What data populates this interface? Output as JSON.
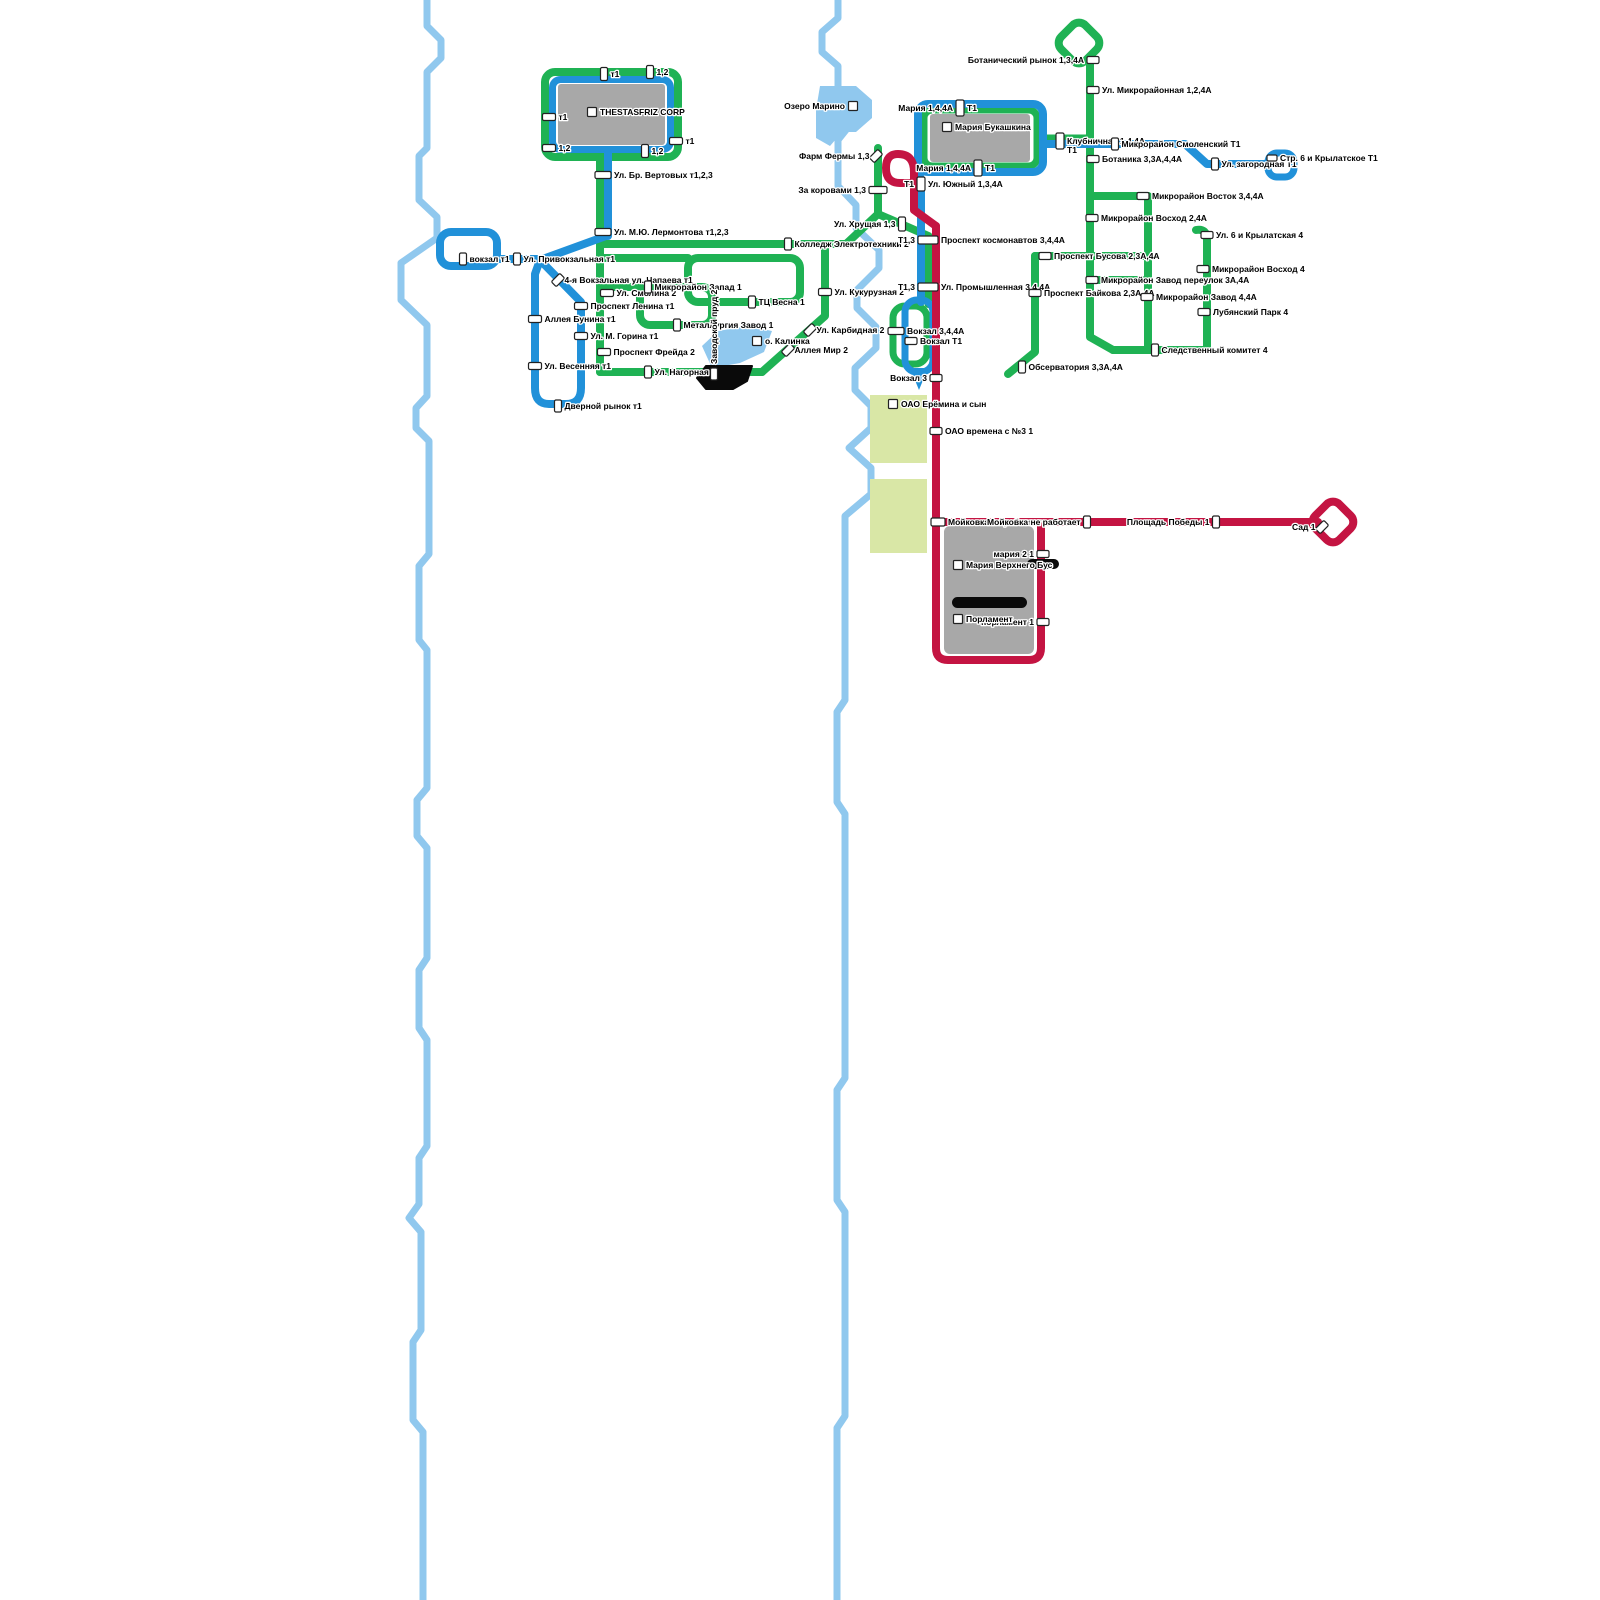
{
  "map": {
    "colors": {
      "route_green": "#1fb254",
      "route_blue": "#2191d9",
      "route_red": "#c41442",
      "river": "#90c8ee",
      "zone_green": "#d9e7a6",
      "building_gray": "#a8a8a8",
      "black": "#0a0a0a",
      "marker_fill": "#ffffff",
      "marker_stroke": "#222222"
    },
    "routes": [
      {
        "id": "green",
        "label": "1 / 2 / 3A / 4 / 4A",
        "color": "#1fb254"
      },
      {
        "id": "blue",
        "label": "T1",
        "color": "#2191d9"
      },
      {
        "id": "red",
        "label": "1 / 3",
        "color": "#c41442"
      }
    ],
    "stops": [
      {
        "x": 604,
        "y": 74,
        "w": 7,
        "h": 13,
        "right": "т1"
      },
      {
        "x": 650,
        "y": 72,
        "w": 7,
        "h": 13,
        "right": "1,2"
      },
      {
        "x": 549,
        "y": 117,
        "w": 13,
        "h": 7,
        "right": "т1"
      },
      {
        "x": 549,
        "y": 148,
        "w": 13,
        "h": 7,
        "right": "1,2"
      },
      {
        "x": 676,
        "y": 141,
        "w": 13,
        "h": 7,
        "right": "т1"
      },
      {
        "x": 645,
        "y": 151,
        "w": 7,
        "h": 13,
        "right": "1,2"
      },
      {
        "x": 603,
        "y": 175,
        "w": 16,
        "h": 7,
        "right": "Ул. Бр. Вертовых т1,2,3"
      },
      {
        "x": 603,
        "y": 232,
        "w": 16,
        "h": 7,
        "right": "Ул. М.Ю. Лермонтова т1,2,3"
      },
      {
        "x": 463,
        "y": 259,
        "w": 7,
        "h": 12,
        "right": "вокзал т1"
      },
      {
        "x": 517,
        "y": 259,
        "w": 7,
        "h": 12,
        "right": "Ул. Привокзальная т1"
      },
      {
        "x": 558,
        "y": 280,
        "w": 7,
        "h": 12,
        "rot": 45,
        "right": "4-я Вокзальная ул. Чапаева т1"
      },
      {
        "x": 607,
        "y": 293,
        "w": 13,
        "h": 7,
        "right": "Ул. Смолина 2"
      },
      {
        "x": 581,
        "y": 306,
        "w": 13,
        "h": 7,
        "right": "Проспект Ленина т1"
      },
      {
        "x": 535,
        "y": 319,
        "w": 13,
        "h": 7,
        "right": "Аллея Бунина т1"
      },
      {
        "x": 581,
        "y": 336,
        "w": 13,
        "h": 7,
        "right": "Ул. М. Горина т1"
      },
      {
        "x": 535,
        "y": 366,
        "w": 13,
        "h": 7,
        "right": "Ул. Весенняя т1"
      },
      {
        "x": 604,
        "y": 352,
        "w": 13,
        "h": 7,
        "right": "Проспект Фрейда 2"
      },
      {
        "x": 558,
        "y": 406,
        "w": 7,
        "h": 12,
        "right": "Дверной рынок т1"
      },
      {
        "x": 648,
        "y": 287,
        "w": 7,
        "h": 12,
        "right": "Микрорайон Запад 1"
      },
      {
        "x": 677,
        "y": 325,
        "w": 7,
        "h": 12,
        "right": "Металлургия Завод 1"
      },
      {
        "x": 752,
        "y": 302,
        "w": 7,
        "h": 12,
        "right": "ТЦ Весна 1"
      },
      {
        "x": 788,
        "y": 244,
        "w": 7,
        "h": 12,
        "right": "Колледж Электротехники 2"
      },
      {
        "x": 648,
        "y": 372,
        "w": 7,
        "h": 12,
        "right": "Ул. Нагорная 2"
      },
      {
        "x": 714,
        "y": 374,
        "w": 7,
        "h": 12,
        "vert": "Заводской пруд 2"
      },
      {
        "x": 825,
        "y": 292,
        "w": 13,
        "h": 7,
        "right": "Ул. Кукурузная 2"
      },
      {
        "x": 810,
        "y": 330,
        "w": 7,
        "h": 12,
        "rot": 45,
        "right": "Ул. Карбидная 2"
      },
      {
        "x": 788,
        "y": 350,
        "w": 7,
        "h": 12,
        "rot": 45,
        "right": "Аллея Мир 2"
      },
      {
        "x": 876,
        "y": 156,
        "w": 7,
        "h": 12,
        "rot": 45,
        "left": "Фарм Фермы 1,3"
      },
      {
        "x": 878,
        "y": 190,
        "w": 18,
        "h": 7,
        "left": "За коровами 1,3"
      },
      {
        "x": 902,
        "y": 224,
        "w": 7,
        "h": 14,
        "left": "Ул. Хрущая 1,3"
      },
      {
        "x": 921,
        "y": 184,
        "w": 8,
        "h": 14,
        "left": "T1",
        "right": "Ул. Южный 1,3,4A"
      },
      {
        "x": 928,
        "y": 240,
        "w": 20,
        "h": 8,
        "left": "T1,3",
        "right": "Проспект космонавтов 3,4,4A"
      },
      {
        "x": 928,
        "y": 287,
        "w": 20,
        "h": 8,
        "left": "T1,3",
        "right": "Ул. Промышленная 3,4,4A"
      },
      {
        "x": 896,
        "y": 331,
        "w": 16,
        "h": 7,
        "right": "Вокзал 3,4,4A"
      },
      {
        "x": 911,
        "y": 341,
        "w": 12,
        "h": 7,
        "right": "Вокзал T1"
      },
      {
        "x": 936,
        "y": 378,
        "w": 12,
        "h": 7,
        "left": "Вокзал 3"
      },
      {
        "x": 936,
        "y": 431,
        "w": 12,
        "h": 7,
        "right": "ОАО времена с №3 1"
      },
      {
        "x": 938,
        "y": 522,
        "w": 14,
        "h": 8,
        "right": "Мойковка не работает"
      },
      {
        "x": 1087,
        "y": 522,
        "w": 7,
        "h": 12,
        "left": "Мойковка не работает"
      },
      {
        "x": 1216,
        "y": 522,
        "w": 7,
        "h": 12,
        "left": "Площадь Победы 1"
      },
      {
        "x": 1322,
        "y": 527,
        "w": 7,
        "h": 12,
        "rot": 45,
        "left": "Сад 1"
      },
      {
        "x": 1043,
        "y": 554,
        "w": 12,
        "h": 7,
        "left": "мария 2 1"
      },
      {
        "x": 1043,
        "y": 622,
        "w": 12,
        "h": 7,
        "left": "порламент 1"
      },
      {
        "x": 960,
        "y": 108,
        "w": 8,
        "h": 16,
        "left": "Мария 1,4,4A",
        "right": "T1"
      },
      {
        "x": 978,
        "y": 168,
        "w": 8,
        "h": 16,
        "left": "Мария 1,4,4A",
        "right": "T1"
      },
      {
        "x": 1060,
        "y": 141,
        "w": 8,
        "h": 16,
        "right": [
          "Клубничная 1,4,4A",
          "T1"
        ]
      },
      {
        "x": 1115,
        "y": 144,
        "w": 7,
        "h": 12,
        "right": "Микрорайон Смоленский T1"
      },
      {
        "x": 1215,
        "y": 164,
        "w": 7,
        "h": 12,
        "right": "Ул. загородная T1"
      },
      {
        "x": 1272,
        "y": 158,
        "w": 10,
        "h": 6,
        "right": "Стр. 6 и Крылатское Т1"
      },
      {
        "x": 1093,
        "y": 60,
        "w": 12,
        "h": 7,
        "left": "Ботанический рынок 1,3,4A"
      },
      {
        "x": 1093,
        "y": 90,
        "w": 12,
        "h": 7,
        "right": "Ул. Микрорайонная 1,2,4A"
      },
      {
        "x": 1093,
        "y": 159,
        "w": 12,
        "h": 7,
        "right": "Ботаника 3,3A,4,4A"
      },
      {
        "x": 1143,
        "y": 196,
        "w": 12,
        "h": 7,
        "right": "Микрорайон Восток 3,4,4A"
      },
      {
        "x": 1092,
        "y": 218,
        "w": 12,
        "h": 7,
        "right": "Микрорайон Восход 2,4A"
      },
      {
        "x": 1045,
        "y": 256,
        "w": 12,
        "h": 7,
        "right": "Проспект Бусова 2,3A,4A"
      },
      {
        "x": 1035,
        "y": 293,
        "w": 12,
        "h": 7,
        "right": "Проспект Байкова 2,3A,4A"
      },
      {
        "x": 1092,
        "y": 280,
        "w": 12,
        "h": 7,
        "right": "Микрорайон Завод переулок 3A,4A"
      },
      {
        "x": 1147,
        "y": 297,
        "w": 12,
        "h": 7,
        "right": "Микрорайон Завод 4,4A"
      },
      {
        "x": 1203,
        "y": 269,
        "w": 12,
        "h": 7,
        "right": "Микрорайон Восход 4"
      },
      {
        "x": 1204,
        "y": 312,
        "w": 12,
        "h": 7,
        "right": "Лубянский Парк 4"
      },
      {
        "x": 1207,
        "y": 235,
        "w": 12,
        "h": 7,
        "right": "Ул. 6 и Крылатская 4"
      },
      {
        "x": 1155,
        "y": 350,
        "w": 7,
        "h": 12,
        "right": "Следственный комитет 4"
      },
      {
        "x": 1022,
        "y": 367,
        "w": 7,
        "h": 12,
        "right": "Обсерватория 3,3A,4A"
      }
    ],
    "poi_labels": [
      {
        "x": 592,
        "y": 112,
        "side": "right",
        "text": "THESTASFRIZ CORP"
      },
      {
        "x": 947,
        "y": 127,
        "side": "right",
        "text": "Мария Букашкина"
      },
      {
        "x": 893,
        "y": 404,
        "side": "right",
        "text": "ОАО Ерёмина и сын"
      },
      {
        "x": 958,
        "y": 565,
        "side": "right",
        "text": "Мария Верхнего Бус"
      },
      {
        "x": 958,
        "y": 619,
        "side": "right",
        "text": "Порламент"
      },
      {
        "x": 853,
        "y": 106,
        "side": "left",
        "text": "Озеро Марино"
      },
      {
        "x": 757,
        "y": 341,
        "side": "right",
        "text": "о. Калинка"
      }
    ]
  }
}
